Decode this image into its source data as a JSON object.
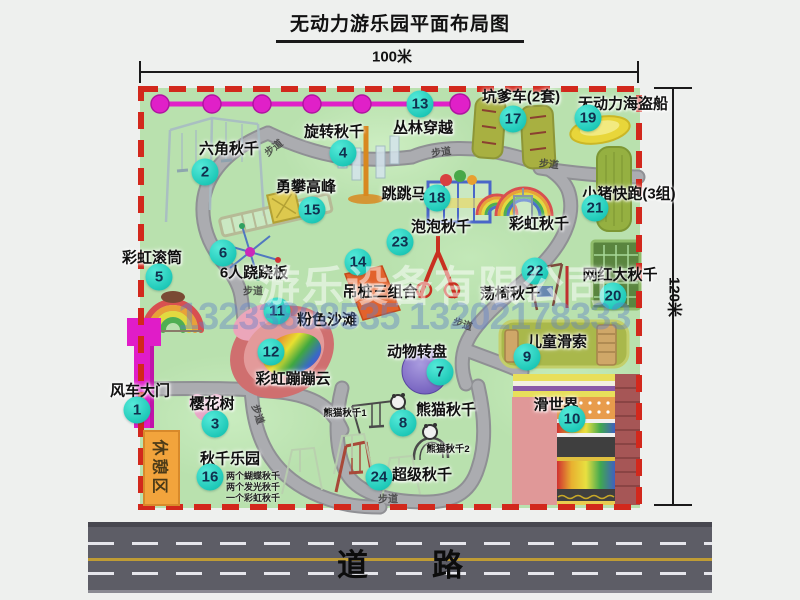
{
  "title": "无动力游乐园平面布局图",
  "dimensions": {
    "top": "100米",
    "right": "120米"
  },
  "watermark": {
    "company": "游乐设备有限公司",
    "phones": "13233808535 13202178333"
  },
  "road_label": "道路",
  "path_label": "步道",
  "labels": {
    "rest_area": "休憩区",
    "rainbow_swing": "彩虹秋千",
    "panda_small_1": "熊猫秋千1",
    "panda_small_2": "熊猫秋千2"
  },
  "swing_park_notes": [
    "两个蝴蝶秋千",
    "两个发光秋千",
    "一个彩虹秋千"
  ],
  "attractions": [
    {
      "num": "1",
      "label": "风车大门"
    },
    {
      "num": "2",
      "label": "六角秋千"
    },
    {
      "num": "3",
      "label": "樱花树"
    },
    {
      "num": "4",
      "label": "旋转秋千"
    },
    {
      "num": "5",
      "label": "彩虹滚筒"
    },
    {
      "num": "6",
      "label": "6人跷跷板"
    },
    {
      "num": "7",
      "label": "动物转盘"
    },
    {
      "num": "8",
      "label": "熊猫秋千"
    },
    {
      "num": "9",
      "label": "儿童滑索"
    },
    {
      "num": "10",
      "label": "滑世界"
    },
    {
      "num": "11",
      "label": "粉色沙滩"
    },
    {
      "num": "12",
      "label": "彩虹蹦蹦云"
    },
    {
      "num": "13",
      "label": "丛林穿越"
    },
    {
      "num": "14",
      "label": "吊桩三组合"
    },
    {
      "num": "15",
      "label": "勇攀高峰"
    },
    {
      "num": "16",
      "label": "秋千乐园"
    },
    {
      "num": "17",
      "label": "坑爹车(2套)"
    },
    {
      "num": "18",
      "label": "跳跳马"
    },
    {
      "num": "19",
      "label": "无动力海盗船"
    },
    {
      "num": "20",
      "label": "网红大秋千"
    },
    {
      "num": "21",
      "label": "小猪快跑(3组)"
    },
    {
      "num": "22",
      "label": "荡椅秋千"
    },
    {
      "num": "23",
      "label": "泡泡秋千"
    },
    {
      "num": "24",
      "label": "超级秋千"
    }
  ],
  "colors": {
    "park_green": "#b9e1ae",
    "border_red": "#d2281c",
    "badge_cyan": "#22d3c2",
    "gate_magenta": "#e01cc8",
    "road_gray": "#5d5d66"
  }
}
